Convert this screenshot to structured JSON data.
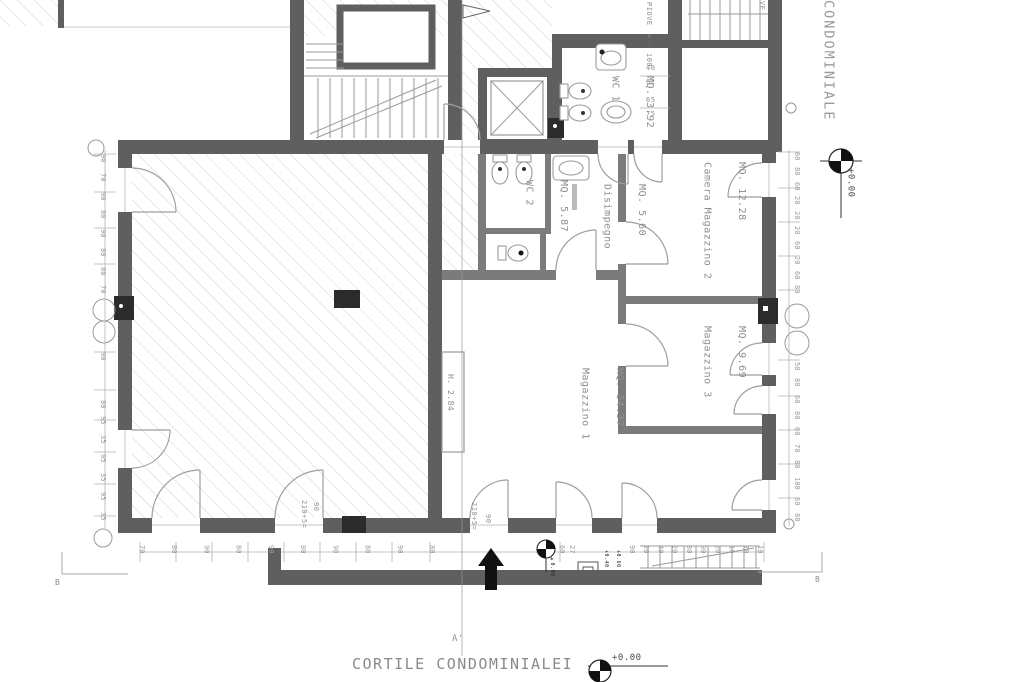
{
  "titles": {
    "condominiale": "CONDOMINIALE",
    "cortile": "CORTILE CONDOMINIALEI"
  },
  "rooms": {
    "wc1": {
      "name": "WC 1",
      "area": "MQ. 3.92"
    },
    "wc2": {
      "name": "WC 2",
      "area": "MQ. 5.87"
    },
    "disimpegno": {
      "name": "Disimpegno",
      "area": "MQ. 5.60"
    },
    "camera_magazzino2": {
      "name": "Camera Magazzino 2",
      "area": "MQ. 12.28"
    },
    "magazzino3": {
      "name": "Magazzino 3",
      "area": "MQ. 9.69"
    },
    "magazzino1": {
      "name": "Magazzino 1",
      "area": "MQ. 34.37"
    }
  },
  "annotations": {
    "height_label": "H. 2.84",
    "piove": "PIOVE",
    "piove_level": "= - 100",
    "piove_partial": "VE",
    "door_dim_1": {
      "width": "90",
      "height": "210+5="
    },
    "door_dim_2": {
      "width": "90",
      "height": "210+5="
    }
  },
  "levels": {
    "right": "+0.00",
    "courtyard": "+0.00",
    "entry": "±0.00",
    "steps_a": "+0.40",
    "steps_b": "+0.60"
  },
  "markers": {
    "section_a_bottom": "A'",
    "section_b_left": "B",
    "section_b_right": "B"
  },
  "dimensions": {
    "left_upper": [
      "90",
      "70",
      "90",
      "80",
      "90",
      "80",
      "80",
      "70"
    ],
    "left_mid": [
      "90",
      "80"
    ],
    "left_lower": [
      "95",
      "35",
      "95",
      "35",
      "95",
      "35"
    ],
    "right_upper": [
      "60",
      "80",
      "60",
      "20",
      "20",
      "20",
      "60",
      "20",
      "60",
      "80"
    ],
    "right_lower": [
      "50",
      "80",
      "60",
      "80",
      "60",
      "70",
      "80",
      "100",
      "60",
      "80"
    ],
    "bottom_left": [
      "70",
      "80",
      "90",
      "80",
      "90",
      "80",
      "90",
      "80",
      "90",
      "80"
    ],
    "bottom_right": [
      "90",
      "20",
      "40",
      "20",
      "30",
      "90",
      "20",
      "10",
      "70",
      "10"
    ],
    "bottom_pair": [
      "60",
      "27"
    ],
    "wc_dim_1": {
      "top": "40",
      "bottom": "62"
    },
    "wc_dim_2": {
      "top": "65",
      "bottom": "75"
    }
  },
  "colors": {
    "wall": "#5f5f5f",
    "wall_dark": "#2b2b2b",
    "line": "#9a9a9a",
    "hatch": "#cfcfcf",
    "text": "#8f8f8f",
    "background": "#ffffff"
  }
}
